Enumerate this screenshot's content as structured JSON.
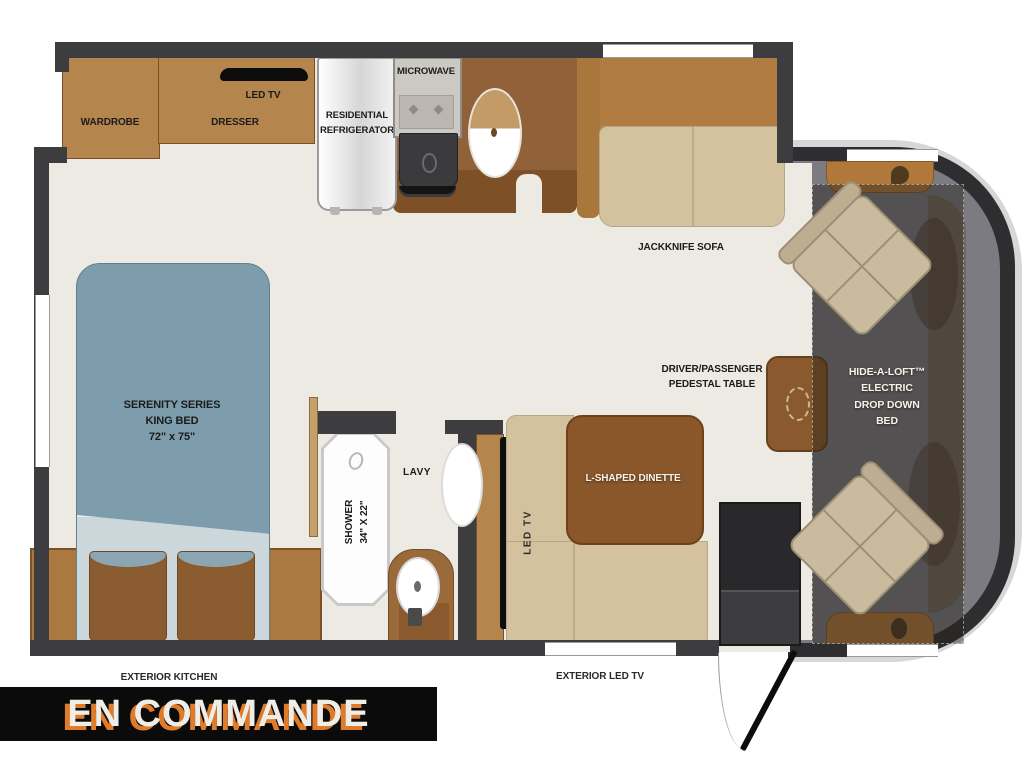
{
  "floorplan": {
    "bedroom": {
      "wardrobe_label": "WARDROBE",
      "dresser_label": "DRESSER",
      "tv_label": "LED TV",
      "bed_label": "SERENITY SERIES\nKING BED\n72\" x 75\""
    },
    "kitchen": {
      "refrigerator_label": "RESIDENTIAL\nREFRIGERATOR",
      "microwave_label": "MICROWAVE",
      "exterior_kitchen_label": "EXTERIOR KITCHEN"
    },
    "bathroom": {
      "shower_label": "SHOWER\n34\" X 22\"",
      "lavatory_label": "LAVY"
    },
    "living": {
      "sofa_label": "JACKKNIFE SOFA",
      "dinette_label": "L-SHAPED DINETTE",
      "dinette_tv_label": "LED TV",
      "exterior_tv_label": "EXTERIOR LED TV",
      "pedestal_table_label": "DRIVER/PASSENGER\nPEDESTAL TABLE"
    },
    "cab": {
      "drop_down_bed_label": "HIDE-A-LOFT™\nELECTRIC\nDROP DOWN\nBED"
    }
  },
  "banner": {
    "text": "EN COMMANDE"
  },
  "colors": {
    "wall": "#3d3d40",
    "floor": "#edeae4",
    "cabinet": "#b5854e",
    "counter": "#91613a",
    "sofa_back": "#b17c41",
    "cushion": "#d4c29f",
    "table": "#8a572b",
    "bed": "#7e9dac",
    "bed_blanket": "#ccd7db",
    "cab_floor": "#7b7b81",
    "banner_bg": "#0b0b0b",
    "banner_text": "#f0ede7",
    "banner_shadow": "#e07b2a"
  }
}
